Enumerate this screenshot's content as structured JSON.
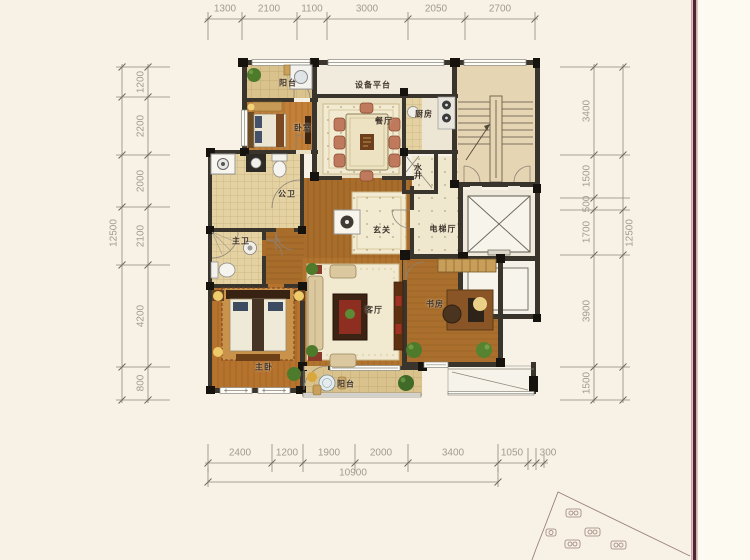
{
  "rooms": {
    "balcony_top": "阳台",
    "equipment_platform": "设备平台",
    "kitchen": "厨房",
    "dining": "餐厅",
    "bedroom": "卧室",
    "water_shaft": "水井",
    "public_bath": "公卫",
    "master_bath": "主卫",
    "entry": "玄关",
    "elevator_hall": "电梯厅",
    "living": "客厅",
    "study": "书房",
    "master_bedroom": "主卧",
    "balcony_bottom": "阳台"
  },
  "dimensions": {
    "top": [
      "1300",
      "2100",
      "1100",
      "3000",
      "2050",
      "2700"
    ],
    "left": [
      "1200",
      "2200",
      "2000",
      "2100",
      "4200",
      "800"
    ],
    "left_total": "12500",
    "right": [
      "3400",
      "1500",
      "500",
      "1700",
      "3900",
      "1500"
    ],
    "right_total": "12500",
    "bottom": [
      "2400",
      "1200",
      "1900",
      "2000",
      "3400",
      "1050",
      "300"
    ],
    "bottom_total": "10900"
  },
  "colors": {
    "wall": "#39342c",
    "wood": "#b0742e",
    "tile": "#d9c28c",
    "rug": "#f1ead0",
    "page_edge_line": "#552433"
  }
}
